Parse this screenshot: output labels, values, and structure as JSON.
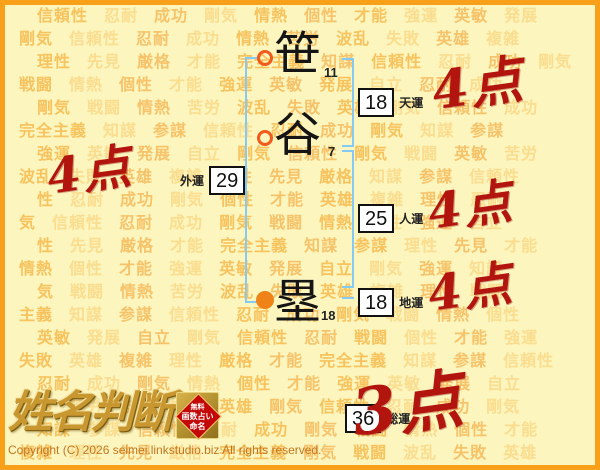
{
  "colors": {
    "background": "#FCF5BD",
    "frame_border": "#F9A01B",
    "bracket_blue": "#85C9F5",
    "score_red": "#B2150E",
    "watermark_orange": "#F4A425",
    "marker_ring": "#F2591C",
    "marker_fill": "#EF8318",
    "logo_gold": "#C9972F",
    "badge_red": "#C40808"
  },
  "name": {
    "characters": [
      {
        "char": "笹",
        "strokes": "11",
        "marker": "hollow-circle"
      },
      {
        "char": "谷",
        "strokes": "7",
        "marker": "hollow-circle"
      },
      {
        "char": "塁",
        "strokes": "18",
        "marker": "filled-circle"
      }
    ]
  },
  "fortunes": [
    {
      "key": "tenun",
      "label": "天運",
      "value": "18",
      "score": "4点"
    },
    {
      "key": "gaiun",
      "label": "外運",
      "value": "29",
      "score": "4点"
    },
    {
      "key": "jinun",
      "label": "人運",
      "value": "25",
      "score": "4点"
    },
    {
      "key": "chiun",
      "label": "地運",
      "value": "18",
      "score": "4点"
    },
    {
      "key": "soun",
      "label": "総運",
      "value": "36",
      "score": "3点"
    }
  ],
  "logo": {
    "title": "姓名判断",
    "badge": {
      "lines": [
        "無料",
        "画数占い",
        "命名"
      ]
    }
  },
  "footer": {
    "copyright": "Copyright (C) 2026 seimei.linkstudio.biz All rights reserved."
  },
  "watermark": {
    "rows": [
      [
        "信頼性",
        "忍耐",
        "成功",
        "剛気",
        "情熱",
        "個性",
        "才能",
        "強運",
        "英敏",
        "発展"
      ],
      [
        "剛気",
        "信頼性",
        "忍耐",
        "成功",
        "情熱",
        "苦労",
        "波乱",
        "失敗",
        "英雄",
        "複雑"
      ],
      [
        "理性",
        "先見",
        "厳格",
        "才能",
        "完全主義",
        "知謀",
        "信頼性",
        "忍耐",
        "成功",
        "剛気"
      ],
      [
        "戦闘",
        "情熱",
        "個性",
        "才能",
        "強運",
        "英敏",
        "発展",
        "自立",
        "忍耐",
        "成功"
      ],
      [
        "剛気",
        "戦闘",
        "情熱",
        "苦労",
        "波乱",
        "失敗",
        "英雄",
        "剛気",
        "信頼性",
        "成功"
      ],
      [
        "完全主義",
        "知謀",
        "参謀",
        "信頼性",
        "忍耐",
        "成功",
        "剛気",
        "知謀",
        "参謀"
      ],
      [
        "強運",
        "英敏",
        "発展",
        "自立",
        "剛気",
        "信頼性",
        "剛気",
        "戦闘",
        "英敏",
        "苦労"
      ],
      [
        "波乱",
        "失敗",
        "英雄",
        "複雑",
        "理性",
        "先見",
        "厳格",
        "知謀",
        "参謀",
        "信頼性"
      ],
      [
        "性",
        "忍耐",
        "成功",
        "剛気",
        "個性",
        "才能",
        "英雄",
        "複雑",
        "理性",
        "忍耐"
      ],
      [
        "気",
        "信頼性",
        "忍耐",
        "成功",
        "剛気",
        "戦闘",
        "情熱",
        "個性",
        "強運",
        "自立"
      ],
      [
        "性",
        "先見",
        "厳格",
        "才能",
        "完全主義",
        "知謀",
        "参謀",
        "理性",
        "先見",
        "才能"
      ],
      [
        "情熱",
        "個性",
        "才能",
        "強運",
        "英敏",
        "発展",
        "自立",
        "剛気",
        "強運",
        "知謀"
      ],
      [
        "気",
        "戦闘",
        "情熱",
        "苦労",
        "波乱",
        "失敗",
        "英雄",
        "複雑",
        "理性",
        "戦闘"
      ],
      [
        "主義",
        "知謀",
        "参謀",
        "信頼性",
        "忍耐",
        "成功",
        "剛気",
        "戦闘",
        "情熱",
        "個性"
      ],
      [
        "英敏",
        "発展",
        "自立",
        "剛気",
        "信頼性",
        "忍耐",
        "戦闘",
        "個性",
        "才能",
        "強運"
      ],
      [
        "失敗",
        "英雄",
        "複雑",
        "理性",
        "厳格",
        "才能",
        "完全主義",
        "知謀",
        "参謀",
        "信頼性"
      ],
      [
        "忍耐",
        "成功",
        "剛気",
        "情熱",
        "個性",
        "才能",
        "強運",
        "英敏",
        "発展",
        "自立"
      ],
      [
        "情熱",
        "苦労",
        "波乱",
        "失敗",
        "英雄",
        "剛気",
        "信頼性",
        "忍耐",
        "成功",
        "剛気"
      ],
      [
        "知謀",
        "参謀",
        "信頼性",
        "忍耐",
        "成功",
        "剛気",
        "戦闘",
        "情熱",
        "個性",
        "才能"
      ],
      [
        "複雑",
        "理性",
        "先見",
        "厳格",
        "完全主義",
        "剛気",
        "戦闘",
        "波乱",
        "失敗",
        "英雄"
      ]
    ]
  }
}
